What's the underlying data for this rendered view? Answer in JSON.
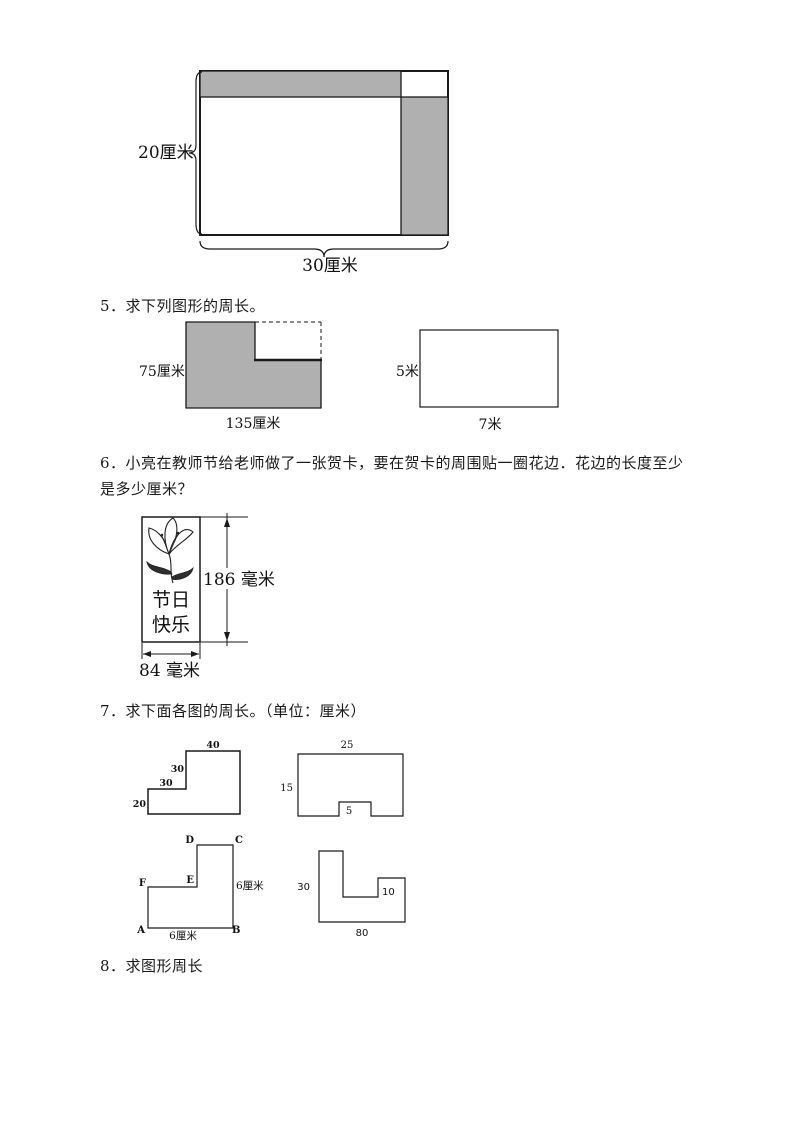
{
  "fig_top": {
    "height_label": "20厘米",
    "width_label": "30厘米"
  },
  "q5": {
    "title": "5．求下列图形的周长。",
    "fig_l_shape": {
      "height_label": "75厘米",
      "width_label": "135厘米"
    },
    "fig_rect": {
      "height_label": "5米",
      "width_label": "7米"
    }
  },
  "q6": {
    "text_line1": "6．小亮在教师节给老师做了一张贺卡，要在贺卡的周围贴一圈花边．花边的长度至少",
    "text_line2": "是多少厘米？",
    "card": {
      "greeting_line1": "节日",
      "greeting_line2": "快乐",
      "height_label": "186 毫米",
      "width_label": "84 毫米"
    }
  },
  "q7": {
    "title": "7．求下面各图的周长。（单位：厘米）",
    "fig_step": {
      "top_label": "40",
      "riser_label": "30",
      "tread_label": "30",
      "left_label": "20"
    },
    "fig_notched": {
      "top_label": "25",
      "left_label": "15",
      "notch_label": "5"
    },
    "fig_lettered": {
      "vertex_a": "A",
      "vertex_b": "B",
      "vertex_c": "C",
      "vertex_d": "D",
      "vertex_e": "E",
      "vertex_f": "F",
      "right_label": "6厘米",
      "bottom_label": "6厘米"
    },
    "fig_blocks": {
      "left_label": "30",
      "inner_label": "10",
      "bottom_label": "80"
    }
  },
  "q8": {
    "title": "8．求图形周长"
  },
  "colors": {
    "shade_gray": "#b0b0b0",
    "line": "#1a1a1a"
  }
}
